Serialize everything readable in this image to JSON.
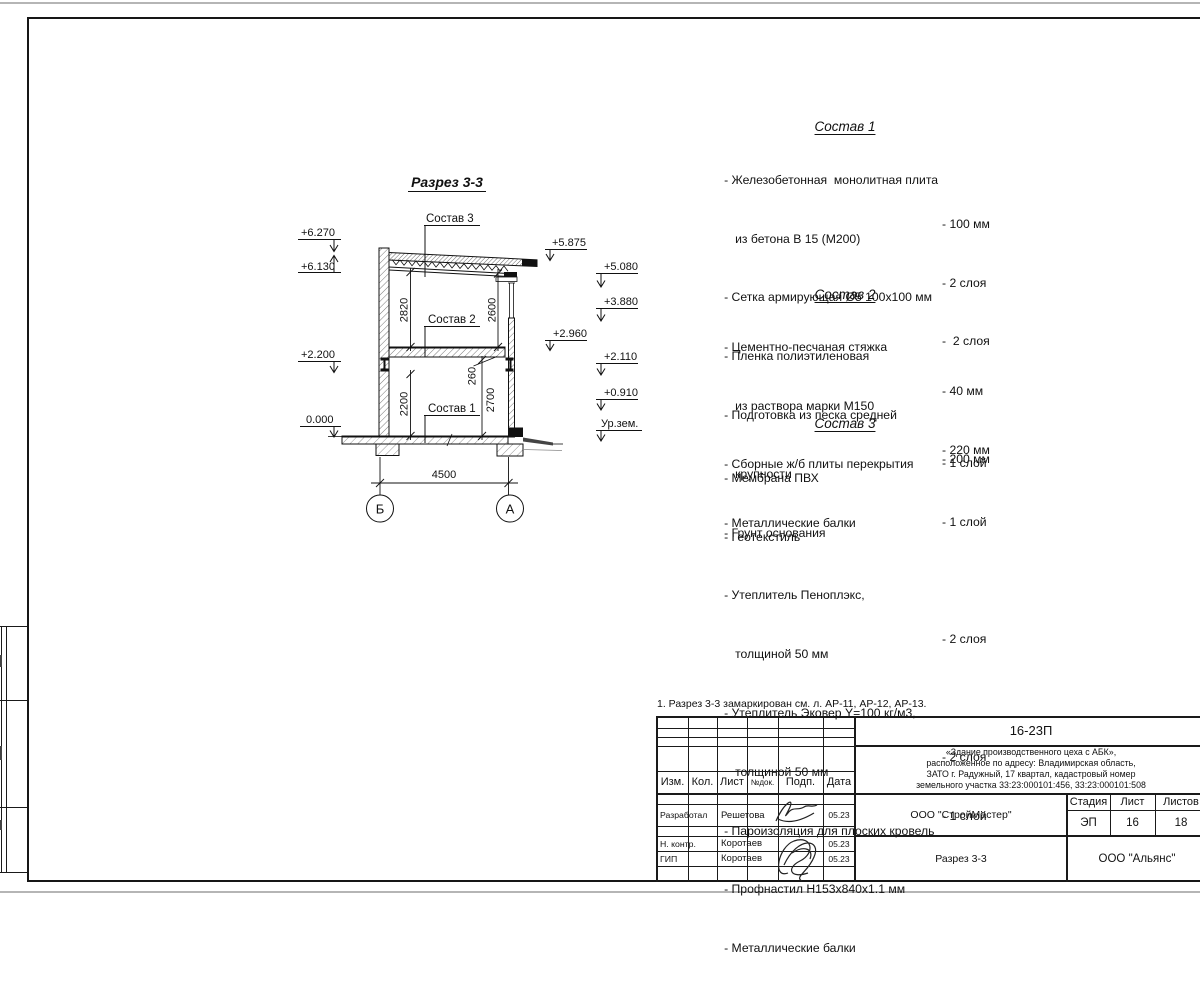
{
  "drawing": {
    "title": "Разрез 3-3",
    "labels": {
      "sostav1": "Состав 1",
      "sostav2": "Состав 2",
      "sostav3": "Состав 3"
    },
    "elev": {
      "e6270": "+6.270",
      "e6130": "+6.130",
      "e2200": "+2.200",
      "e0000": "0.000",
      "e5875": "+5.875",
      "e5080": "+5.080",
      "e3880": "+3.880",
      "e2960": "+2.960",
      "e2110": "+2.110",
      "e0910": "+0.910",
      "ground": "Ур.зем."
    },
    "dims": {
      "w": "4500",
      "hu1": "2820",
      "hu2": "2600",
      "hl1": "2200",
      "slab": "260",
      "hl2": "2700"
    },
    "axes": {
      "left": "Б",
      "right": "А"
    }
  },
  "sostav_lists": [
    {
      "title": "Состав 1",
      "items": [
        {
          "text": "- Железобетонная  монолитная плита",
          "value": ""
        },
        {
          "text": "из бетона В 15 (М200)",
          "value": "- 100 мм",
          "indent": true
        },
        {
          "text": "- Сетка армирующая Ø5 100х100 мм",
          "value": "- 2 слоя"
        },
        {
          "text": "- Пленка полиэтиленовая",
          "value": "-  2 слоя"
        },
        {
          "text": "- Подготовка из песка средней",
          "value": ""
        },
        {
          "text": "крупности",
          "value": "- 200 мм",
          "indent": true
        },
        {
          "text": "- Грунт основания",
          "value": ""
        }
      ]
    },
    {
      "title": "Состав 2",
      "items": [
        {
          "text": "- Цементно-песчаная стяжка",
          "value": ""
        },
        {
          "text": "из раствора марки М150",
          "value": "- 40 мм",
          "indent": true
        },
        {
          "text": "- Сборные ж/б плиты перекрытия",
          "value": "- 220 мм"
        },
        {
          "text": "- Металлические балки",
          "value": ""
        }
      ]
    },
    {
      "title": "Состав 3",
      "items": [
        {
          "text": "- Мембрана ПВХ",
          "value": "- 1 слой"
        },
        {
          "text": "- Геотекстиль",
          "value": "- 1 слой"
        },
        {
          "text": "- Утеплитель Пеноплэкс,",
          "value": ""
        },
        {
          "text": "толщиной 50 мм",
          "value": "- 2 слоя",
          "indent": true
        },
        {
          "text": "- Утеплитель Эковер Y=100 кг/м3,",
          "value": ""
        },
        {
          "text": "толщиной 50 мм",
          "value": "- 2 слоя",
          "indent": true
        },
        {
          "text": "- Пароизоляция для плоских кровель",
          "value": "- 1 слой"
        },
        {
          "text": "- Профнастил Н153х840х1.1 мм",
          "value": ""
        },
        {
          "text": "- Металлические балки",
          "value": ""
        }
      ]
    }
  ],
  "note": "1. Разрез 3-3 замаркирован см. л. АР-11, АР-12, АР-13.",
  "titleblock": {
    "doc_number": "16-23П",
    "project_lines": [
      "«Здание производственного цеха с АБК»,",
      "расположенное по адресу: Владимирская область,",
      "ЗАТО г. Радужный, 17 квартал, кадастровый номер",
      "земельного участка 33:23:000101:456, 33:23:000101:508"
    ],
    "columns": {
      "izm": "Изм.",
      "kol": "Кол.",
      "list": "Лист",
      "ndok": "№док.",
      "podp": "Подп.",
      "data": "Дата"
    },
    "rows": [
      {
        "role": "Разработал",
        "name": "Решетова",
        "date": "05.23"
      },
      {
        "role": "Н. контр.",
        "name": "Коротаев",
        "date": "05.23"
      },
      {
        "role": "ГИП",
        "name": "Коротаев",
        "date": "05.23"
      }
    ],
    "org": "ООО \"СтройМастер\"",
    "stage_label": "Стадия",
    "sheet_label": "Лист",
    "sheets_label": "Листов",
    "stage": "ЭП",
    "sheet": "16",
    "sheets": "18",
    "sheet_title": "Разрез 3-3",
    "customer": "ООО \"Альянс\""
  }
}
